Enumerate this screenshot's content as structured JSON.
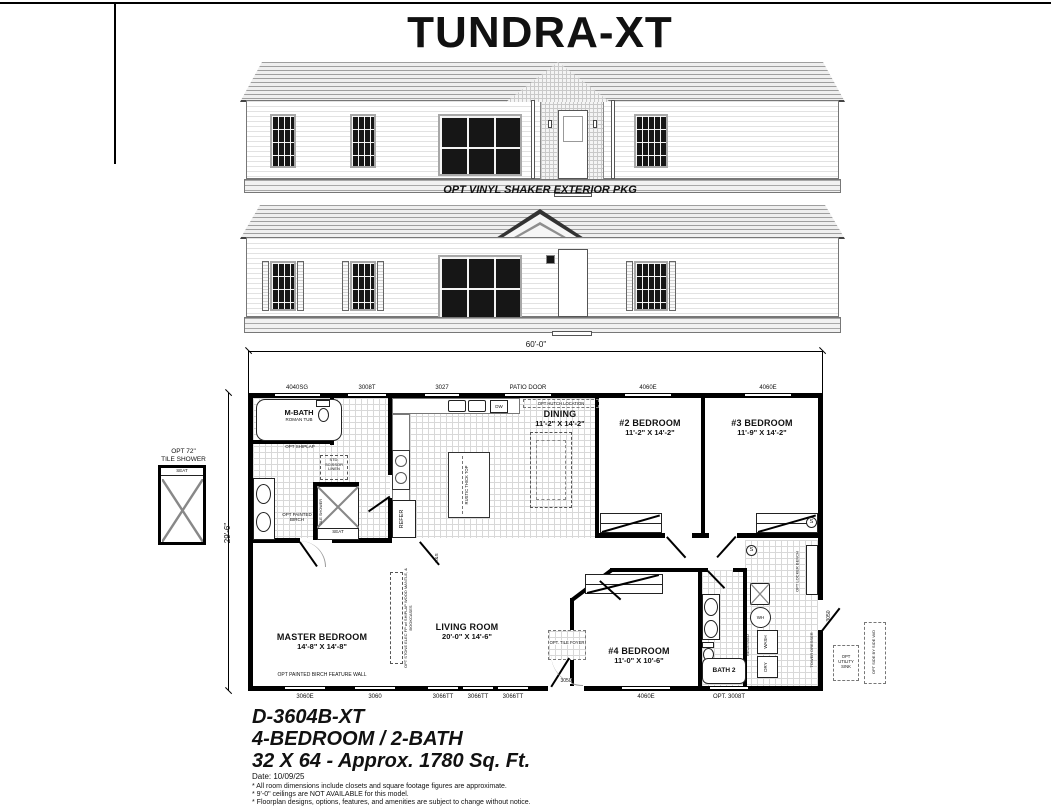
{
  "page": {
    "title": "TUNDRA-XT"
  },
  "elevations": {
    "caption": "OPT VINYL SHAKER EXTERIOR PKG"
  },
  "plan": {
    "dim_top": "60'-0\"",
    "dim_left": "29'-6\"",
    "top_labels": [
      "4040SG",
      "3008T",
      "3027",
      "PATIO DOOR",
      "4060E",
      "4060E"
    ],
    "bottom_labels": [
      "3060E",
      "3060",
      "3066TT",
      "3066TT",
      "3066TT",
      "4060E",
      "OPT. 3008T"
    ],
    "front_door": "3050",
    "rear_door": "3050",
    "rooms": {
      "mbath": {
        "name": "M-BATH",
        "sub": "ROMAN TUB"
      },
      "dining": {
        "name": "DINING",
        "dims": "11'-2\" X 14'-2\""
      },
      "bed2": {
        "name": "#2 BEDROOM",
        "dims": "11'-2\" X 14'-2\""
      },
      "bed3": {
        "name": "#3 BEDROOM",
        "dims": "11'-9\" X 14'-2\""
      },
      "master": {
        "name": "MASTER BEDROOM",
        "dims": "14'-8\" X 14'-8\""
      },
      "living": {
        "name": "LIVING ROOM",
        "dims": "20'-0\" X 14'-6\""
      },
      "bed4": {
        "name": "#4 BEDROOM",
        "dims": "11'-0\" X 10'-6\""
      },
      "bath2": {
        "name": "BATH 2"
      }
    },
    "annotations": {
      "shower_opt_line1": "OPT 72\"",
      "shower_opt_line2": "TILE SHOWER",
      "seat": "SEAT",
      "tile_shower": "TILE SHOWER",
      "linen": "STD. SCISSOR LINEN",
      "shiplap": "OPT SHIPLAP",
      "painted_birch": "OPT PAINTED BIRCH",
      "refer": "REFER",
      "dw": "DW",
      "island": "RUSTIC THICK TOP",
      "hutch": "OPT HUTCH LOCATION",
      "feature_wall": "OPT PAINTED BIRCH FEATURE WALL",
      "fireplace": "OPT STONE ELEC FP w/ SHIPLAP WOOD MANTLE, & BOOKCASES",
      "tile_foyer": "OPT. TILE FOYER",
      "locker_bench": "OPT LOCKER BENCH",
      "water_heater": "WH",
      "wash": "WASH",
      "dry": "DRY",
      "recessed": "RECESSED",
      "tower_dresser": "TOWER DRESSER",
      "utility_sink": "OPT UTILITY SINK",
      "side_by_side": "OPT SIDE BY SIDE W/D",
      "rod_shelf": "R&S",
      "smoke": "S"
    }
  },
  "title_block": {
    "model": "D-3604B-XT",
    "config": "4-BEDROOM / 2-BATH",
    "size": "32 X 64 - Approx. 1780 Sq. Ft.",
    "date": "Date: 10/09/25",
    "notes": [
      "* All room dimensions include closets and square footage figures are approximate.",
      "* 9'-0\" ceilings are NOT AVAILABLE for this model.",
      "* Floorplan designs, options, features, and amenities are subject to change without notice."
    ]
  }
}
